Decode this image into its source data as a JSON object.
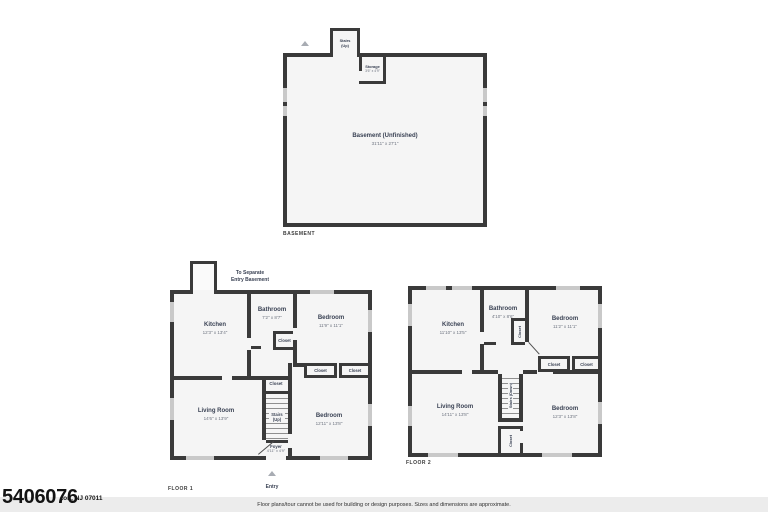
{
  "watermark": {
    "number": "5406076",
    "address": "ton, NJ 07011"
  },
  "footer": {
    "disclaimer": "Floor plans/tour cannot be used for building or design purposes. Sizes and dimensions are approximate."
  },
  "shared": {
    "closet": "Closet",
    "stairs_up": "Stairs\n(Up)",
    "stairs_down": "Stairs (Down)",
    "entry": "Entry",
    "to_home": "To Home",
    "to_separate": "To Separate\nEntry Basement"
  },
  "basement": {
    "caption": "BASEMENT",
    "name": "Basement (Unfinished)",
    "dims": "31'11\" x 27'1\"",
    "storage_name": "Storage",
    "storage_dims": "3'6\" x 4'9\""
  },
  "floor1": {
    "caption": "FLOOR 1",
    "kitchen": {
      "name": "Kitchen",
      "dims": "12'3\" x 13'4\""
    },
    "bathroom": {
      "name": "Bathroom",
      "dims": "7'2\" x 8'7\""
    },
    "bedroom_top": {
      "name": "Bedroom",
      "dims": "11'9\" x 11'1\""
    },
    "living_room": {
      "name": "Living Room",
      "dims": "14'6\" x 13'9\""
    },
    "bedroom_bottom": {
      "name": "Bedroom",
      "dims": "12'11\" x 13'8\""
    },
    "foyer": {
      "name": "Foyer",
      "dims": "4'11\" x 4'9\""
    }
  },
  "floor2": {
    "caption": "FLOOR 2",
    "kitchen": {
      "name": "Kitchen",
      "dims": "11'10\" x 13'5\""
    },
    "bathroom": {
      "name": "Bathroom",
      "dims": "4'10\" x 8'6\""
    },
    "bedroom_top": {
      "name": "Bedroom",
      "dims": "11'2\" x 11'1\""
    },
    "living_room": {
      "name": "Living Room",
      "dims": "14'11\" x 13'8\""
    },
    "bedroom_bottom": {
      "name": "Bedroom",
      "dims": "12'3\" x 13'8\""
    }
  }
}
